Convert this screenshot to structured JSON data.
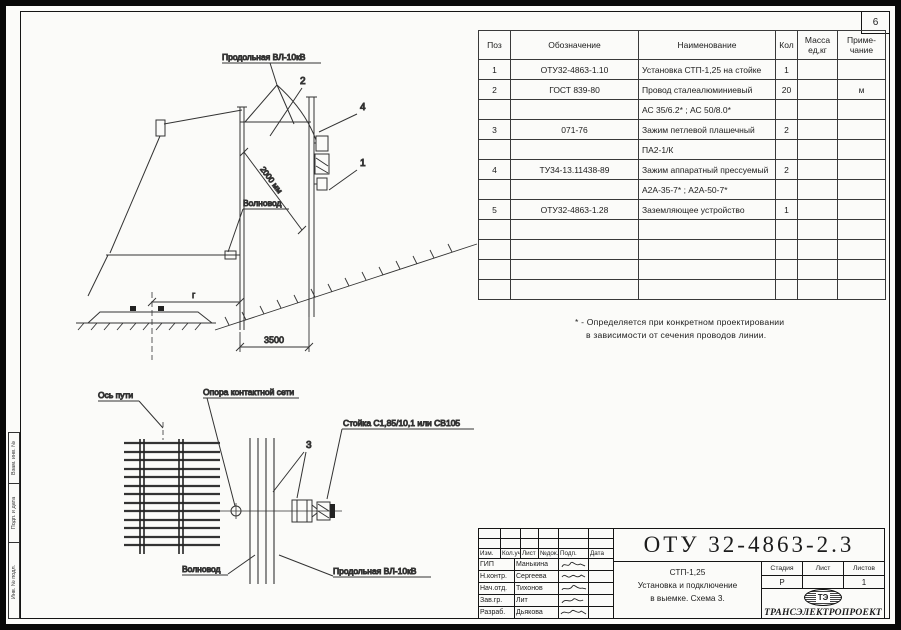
{
  "page": {
    "number": "6"
  },
  "spec_table": {
    "headers": {
      "pos": "Поз",
      "designation": "Обозначение",
      "name": "Наименование",
      "qty": "Кол",
      "mass_l1": "Масса",
      "mass_l2": "ед,кг",
      "note_l1": "Приме-",
      "note_l2": "чание"
    },
    "rows": [
      {
        "pos": "1",
        "designation": "ОТУ32-4863-1.10",
        "name": "Установка СТП-1,25 на стойке",
        "qty": "1",
        "mass": "",
        "note": ""
      },
      {
        "pos": "2",
        "designation": "ГОСТ 839-80",
        "name": "Провод сталеалюминиевый",
        "qty": "20",
        "mass": "",
        "note": "м"
      },
      {
        "pos": "",
        "designation": "",
        "name": "АС 35/6.2* ; АС 50/8.0*",
        "qty": "",
        "mass": "",
        "note": ""
      },
      {
        "pos": "3",
        "designation": "071-76",
        "name": "Зажим петлевой плашечный",
        "qty": "2",
        "mass": "",
        "note": ""
      },
      {
        "pos": "",
        "designation": "",
        "name": "ПА2-1/К",
        "qty": "",
        "mass": "",
        "note": ""
      },
      {
        "pos": "4",
        "designation": "ТУ34-13.11438-89",
        "name": "Зажим аппаратный прессуемый",
        "qty": "2",
        "mass": "",
        "note": ""
      },
      {
        "pos": "",
        "designation": "",
        "name": "А2А-35-7* ; А2А-50-7*",
        "qty": "",
        "mass": "",
        "note": ""
      },
      {
        "pos": "5",
        "designation": "ОТУ32-4863-1.28",
        "name": "Заземляющее устройство",
        "qty": "1",
        "mass": "",
        "note": ""
      },
      {
        "pos": "",
        "designation": "",
        "name": "",
        "qty": "",
        "mass": "",
        "note": ""
      },
      {
        "pos": "",
        "designation": "",
        "name": "",
        "qty": "",
        "mass": "",
        "note": ""
      },
      {
        "pos": "",
        "designation": "",
        "name": "",
        "qty": "",
        "mass": "",
        "note": ""
      },
      {
        "pos": "",
        "designation": "",
        "name": "",
        "qty": "",
        "mass": "",
        "note": ""
      }
    ]
  },
  "footnote": {
    "line1": "* - Определяется при конкретном проектировании",
    "line2": "в зависимости от сечения проводов линии."
  },
  "upper_drawing": {
    "label_vl": "Продольная ВЛ-10кВ",
    "label_waveguide": "Волновод",
    "dim_diag": "2000 мм",
    "dim_span": "3500",
    "dim_g": "г",
    "callout_1": "1",
    "callout_2": "2",
    "callout_4": "4"
  },
  "lower_drawing": {
    "label_track_axis": "Ось пути",
    "label_support": "Опора контактной сети",
    "label_stand": "Стойка С1,85/10,1 или СВ105",
    "label_waveguide": "Волновод",
    "label_vl": "Продольная ВЛ-10кВ",
    "callout_3": "3"
  },
  "title_block": {
    "doc_number": "ОТУ 32-4863-2.3",
    "title_line1": "СТП-1,25",
    "title_line2": "Установка и подключение",
    "title_line3": "в выемке. Схема 3.",
    "change_headers": [
      "Изм.",
      "Кол.уч",
      "Лист",
      "№док.",
      "Подп.",
      "Дата"
    ],
    "signature_rows": [
      {
        "role": "ГИП",
        "name": "Манькина"
      },
      {
        "role": "Н.контр.",
        "name": "Сергеева"
      },
      {
        "role": "Нач.отд.",
        "name": "Тихонов"
      },
      {
        "role": "Зав.гр.",
        "name": "Лит"
      },
      {
        "role": "Разраб.",
        "name": "Дьякова"
      }
    ],
    "stage_header": "Стадия",
    "sheet_header": "Лист",
    "sheets_header": "Листов",
    "stage": "Р",
    "sheet": "",
    "sheets": "1",
    "logo_text": "ТЭ",
    "organization": "ТРАНСЭЛЕКТРОПРОЕКТ"
  },
  "side_stamps": {
    "s1": "Взам. инв. №",
    "s2": "Подп. и дата",
    "s3": "Инв. № подл."
  }
}
